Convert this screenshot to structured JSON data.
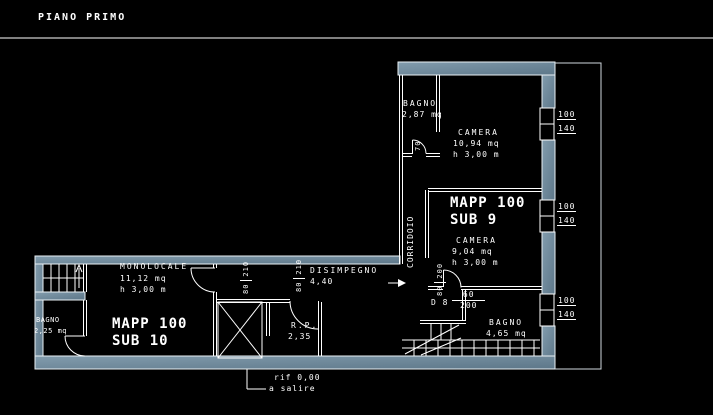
{
  "title": "PIANO PRIMO",
  "colors": {
    "background": "#000000",
    "lines": "#ffffff",
    "wall_fill": "#6b8799"
  },
  "units": {
    "sub9": {
      "mapp": "MAPP 100",
      "sub": "SUB 9"
    },
    "sub10": {
      "mapp": "MAPP 100",
      "sub": "SUB 10"
    }
  },
  "rooms": {
    "bagno_nord": {
      "name": "BAGNO",
      "area": "2,87 mq"
    },
    "camera_nord": {
      "name": "CAMERA",
      "area": "10,94 mq",
      "height": "h 3,00 m"
    },
    "camera_sud": {
      "name": "CAMERA",
      "area": "9,04 mq",
      "height": "h 3,00 m"
    },
    "corridoio": {
      "name": "CORRIDOIO"
    },
    "bagno_est": {
      "name": "BAGNO",
      "area": "4,65 mq"
    },
    "monolocale": {
      "name": "MONOLOCALE",
      "area": "11,12 mq",
      "height": "h 3,00 m"
    },
    "bagno_ovest": {
      "name": "BAGNO",
      "area": "2,25 mq"
    },
    "disimpegno": {
      "name": "DISIMPEGNO",
      "area": "4,40"
    },
    "ripostiglio": {
      "name": "R.P.",
      "area": "2,35"
    }
  },
  "doors": {
    "d8": {
      "label": "D 8",
      "width": "60",
      "height": "200"
    },
    "monolocale_door": {
      "width": "80",
      "height": "210"
    },
    "ripostiglio_door": {
      "width": "80",
      "height": "210"
    },
    "camera_door": {
      "width": "80",
      "height": "200"
    },
    "bagno_nord_door": {
      "width": "70"
    }
  },
  "windows": [
    {
      "width": "100",
      "height": "140"
    },
    {
      "width": "100",
      "height": "140"
    },
    {
      "width": "100",
      "height": "140"
    }
  ],
  "note": {
    "line1": "rif 0,00",
    "line2": "a salire"
  }
}
